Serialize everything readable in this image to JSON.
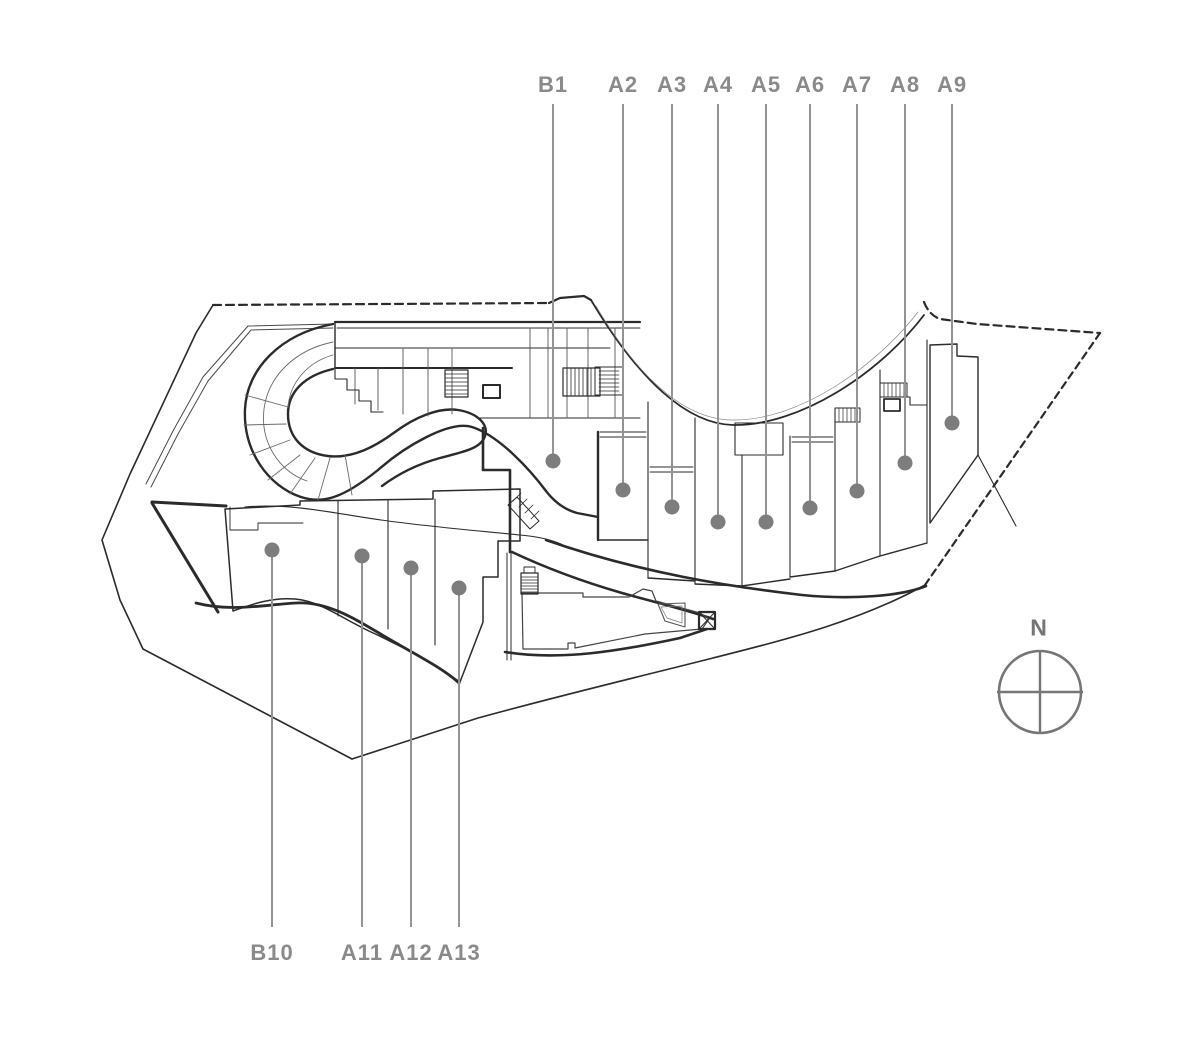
{
  "page": {
    "background": "#ffffff"
  },
  "colors": {
    "label": "#8a8a8a",
    "dot": "#7d7d7d",
    "leader_line": "#949494",
    "plan_line": "#2b2b2b",
    "compass": "#757575"
  },
  "layout_values": {
    "label_y_top": 85,
    "line_start_top": 104,
    "label_y_bottom": 953,
    "line_end_bottom": 927
  },
  "units": [
    {
      "label": "B1",
      "side": "top",
      "x": 553,
      "dot_y": 461
    },
    {
      "label": "A2",
      "side": "top",
      "x": 623,
      "dot_y": 490
    },
    {
      "label": "A3",
      "side": "top",
      "x": 672,
      "dot_y": 507
    },
    {
      "label": "A4",
      "side": "top",
      "x": 718,
      "dot_y": 522
    },
    {
      "label": "A5",
      "side": "top",
      "x": 766,
      "dot_y": 522
    },
    {
      "label": "A6",
      "side": "top",
      "x": 810,
      "dot_y": 508
    },
    {
      "label": "A7",
      "side": "top",
      "x": 857,
      "dot_y": 491
    },
    {
      "label": "A8",
      "side": "top",
      "x": 905,
      "dot_y": 463
    },
    {
      "label": "A9",
      "side": "top",
      "x": 952,
      "dot_y": 423
    },
    {
      "label": "B10",
      "side": "bottom",
      "x": 272,
      "dot_y": 550
    },
    {
      "label": "A11",
      "side": "bottom",
      "x": 362,
      "dot_y": 556
    },
    {
      "label": "A12",
      "side": "bottom",
      "x": 411,
      "dot_y": 568
    },
    {
      "label": "A13",
      "side": "bottom",
      "x": 459,
      "dot_y": 588
    }
  ],
  "compass": {
    "label": "N",
    "label_x": 1039,
    "label_y": 628,
    "cx": 1040,
    "cy": 692,
    "r": 41
  }
}
